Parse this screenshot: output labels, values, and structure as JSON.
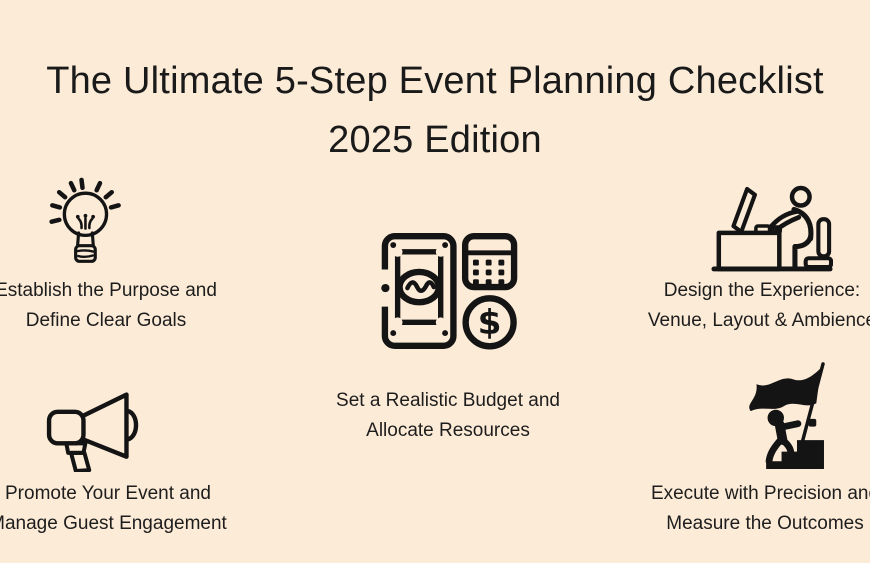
{
  "page": {
    "background_color": "#FCEBD7",
    "text_color": "#1D1D1D",
    "icon_color": "#141414"
  },
  "title": {
    "line1": "The Ultimate 5-Step Event Planning Checklist",
    "line2": "2025 Edition"
  },
  "steps": [
    {
      "icon": "lightbulb-icon",
      "line1": "Establish the Purpose and",
      "line2": "Define Clear Goals"
    },
    {
      "icon": "money-calculator-icon",
      "line1": "Set a Realistic Budget and",
      "line2": "Allocate Resources"
    },
    {
      "icon": "person-at-desk-icon",
      "line1": "Design the Experience:",
      "line2": "Venue, Layout & Ambience"
    },
    {
      "icon": "megaphone-icon",
      "line1": "Promote Your Event and",
      "line2": "Manage Guest Engagement"
    },
    {
      "icon": "flag-climber-icon",
      "line1": "Execute with Precision and",
      "line2": "Measure the Outcomes"
    }
  ]
}
